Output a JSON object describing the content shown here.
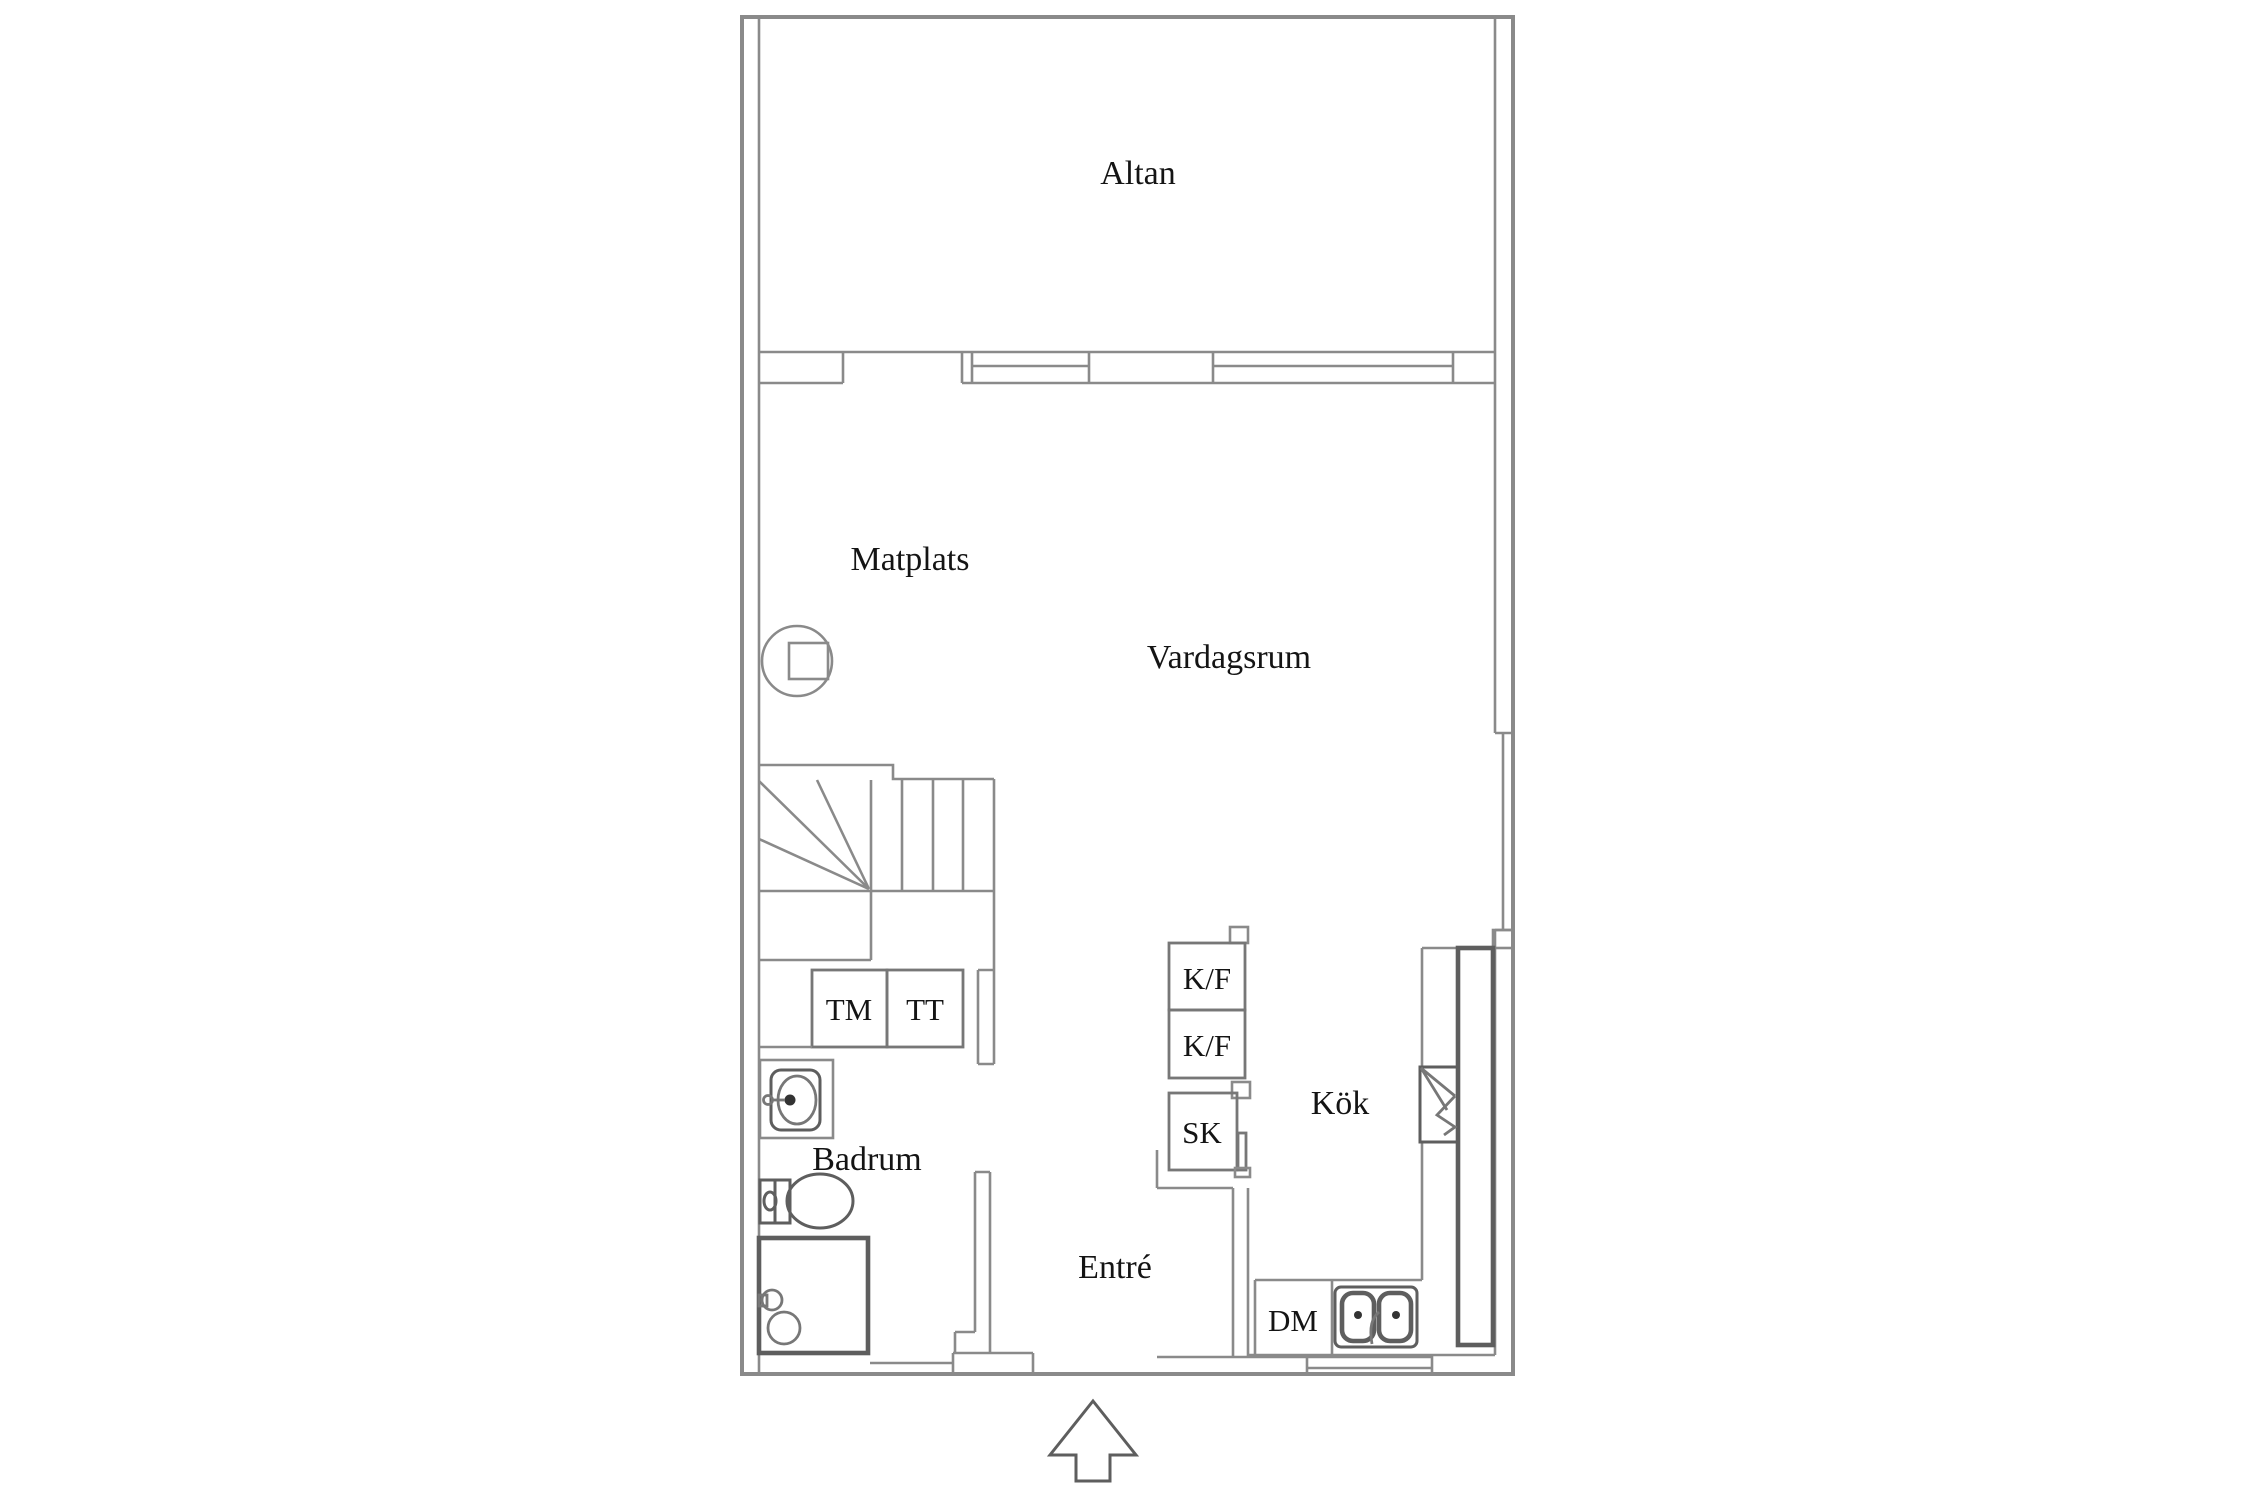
{
  "floorplan": {
    "colors": {
      "wall": "#8a8a8a",
      "dark": "#5e5e5e",
      "mid": "#777777",
      "text": "#141414",
      "bg": "#ffffff"
    },
    "rooms": {
      "altan": "Altan",
      "matplats": "Matplats",
      "vardagsrum": "Vardagsrum",
      "kok": "Kök",
      "badrum": "Badrum",
      "entre": "Entré"
    },
    "appliances": {
      "tm": "TM",
      "tt": "TT",
      "kf_upper": "K/F",
      "kf_lower": "K/F",
      "sk": "SK",
      "dm": "DM"
    },
    "icons": [
      "fireplace-icon",
      "stairs-icon",
      "washbasin-icon",
      "toilet-icon",
      "shower-icon",
      "stove-icon",
      "kitchen-sink-icon",
      "window-icon",
      "entrance-arrow-icon"
    ]
  }
}
